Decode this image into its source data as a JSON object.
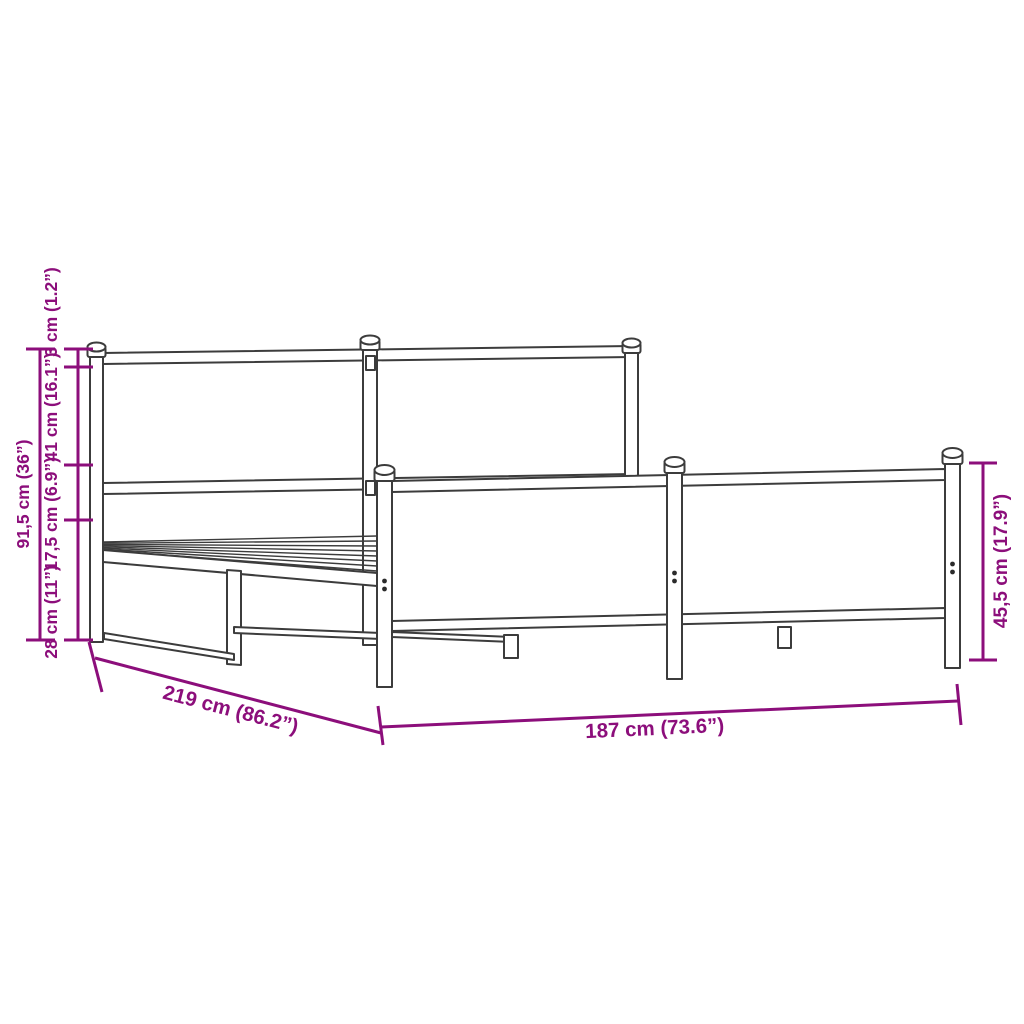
{
  "diagram": {
    "type": "product-dimension-drawing",
    "subject": "metal bed frame with headboard and footboard",
    "colors": {
      "dimension_lines": "#8C0E7B",
      "drawing_lines": "#3C3C3C",
      "background": "#FFFFFF"
    },
    "labels": {
      "total_height": "91,5 cm (36”)",
      "segment_base_height": "28 cm (11”)",
      "segment_rail_height": "17,5 cm (6.9”)",
      "segment_headboard_panel": "41 cm (16.1”)",
      "segment_post_cap": "3 cm (1.2”)",
      "length": "219 cm (86.2”)",
      "width": "187 cm (73.6”)",
      "footboard_height": "45,5 cm (17.9”)"
    }
  }
}
